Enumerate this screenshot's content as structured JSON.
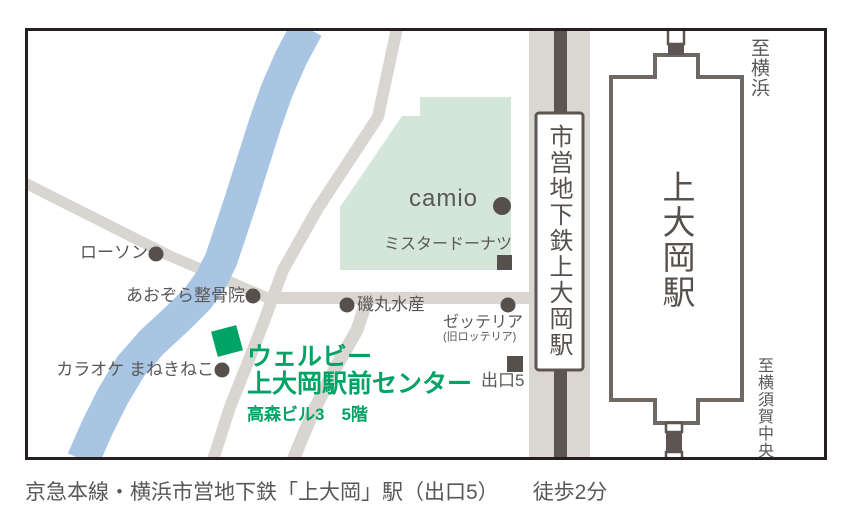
{
  "colors": {
    "road": "#d9d6d2",
    "river": "#a8c6e4",
    "area_green": "#d4e6da",
    "accent_green": "#00a366",
    "marker_dark": "#56504d",
    "line_dark": "#5d5551",
    "text_gray": "#595757",
    "border": "#251f20"
  },
  "map": {
    "landmarks": {
      "lawson": "ローソン",
      "aozora": "あおぞら整骨院",
      "karaoke": "カラオケ まねきねこ",
      "isomaru": "磯丸水産",
      "camio": "camio",
      "mister_donut": "ミスタードーナツ",
      "zetteria": "ゼッテリア",
      "zetteria_sub": "(旧ロッテリア)",
      "exit5": "出口5"
    },
    "destination": {
      "line1": "ウェルビー",
      "line2": "上大岡駅前センター",
      "line3": "高森ビル3　5階"
    },
    "stations": {
      "subway": "市営地下鉄上大岡駅",
      "keikyu": "上大岡駅"
    },
    "directions": {
      "to_yokohama": "至横浜",
      "to_yokosuka": "至横須賀中央"
    },
    "markers": {
      "dot": "dot-marker",
      "square": "square-marker",
      "destination": "green-diamond-marker"
    }
  },
  "caption": {
    "route": "京急本線・横浜市営地下鉄「上大岡」駅（出口5）",
    "walk": "徒歩2分"
  }
}
